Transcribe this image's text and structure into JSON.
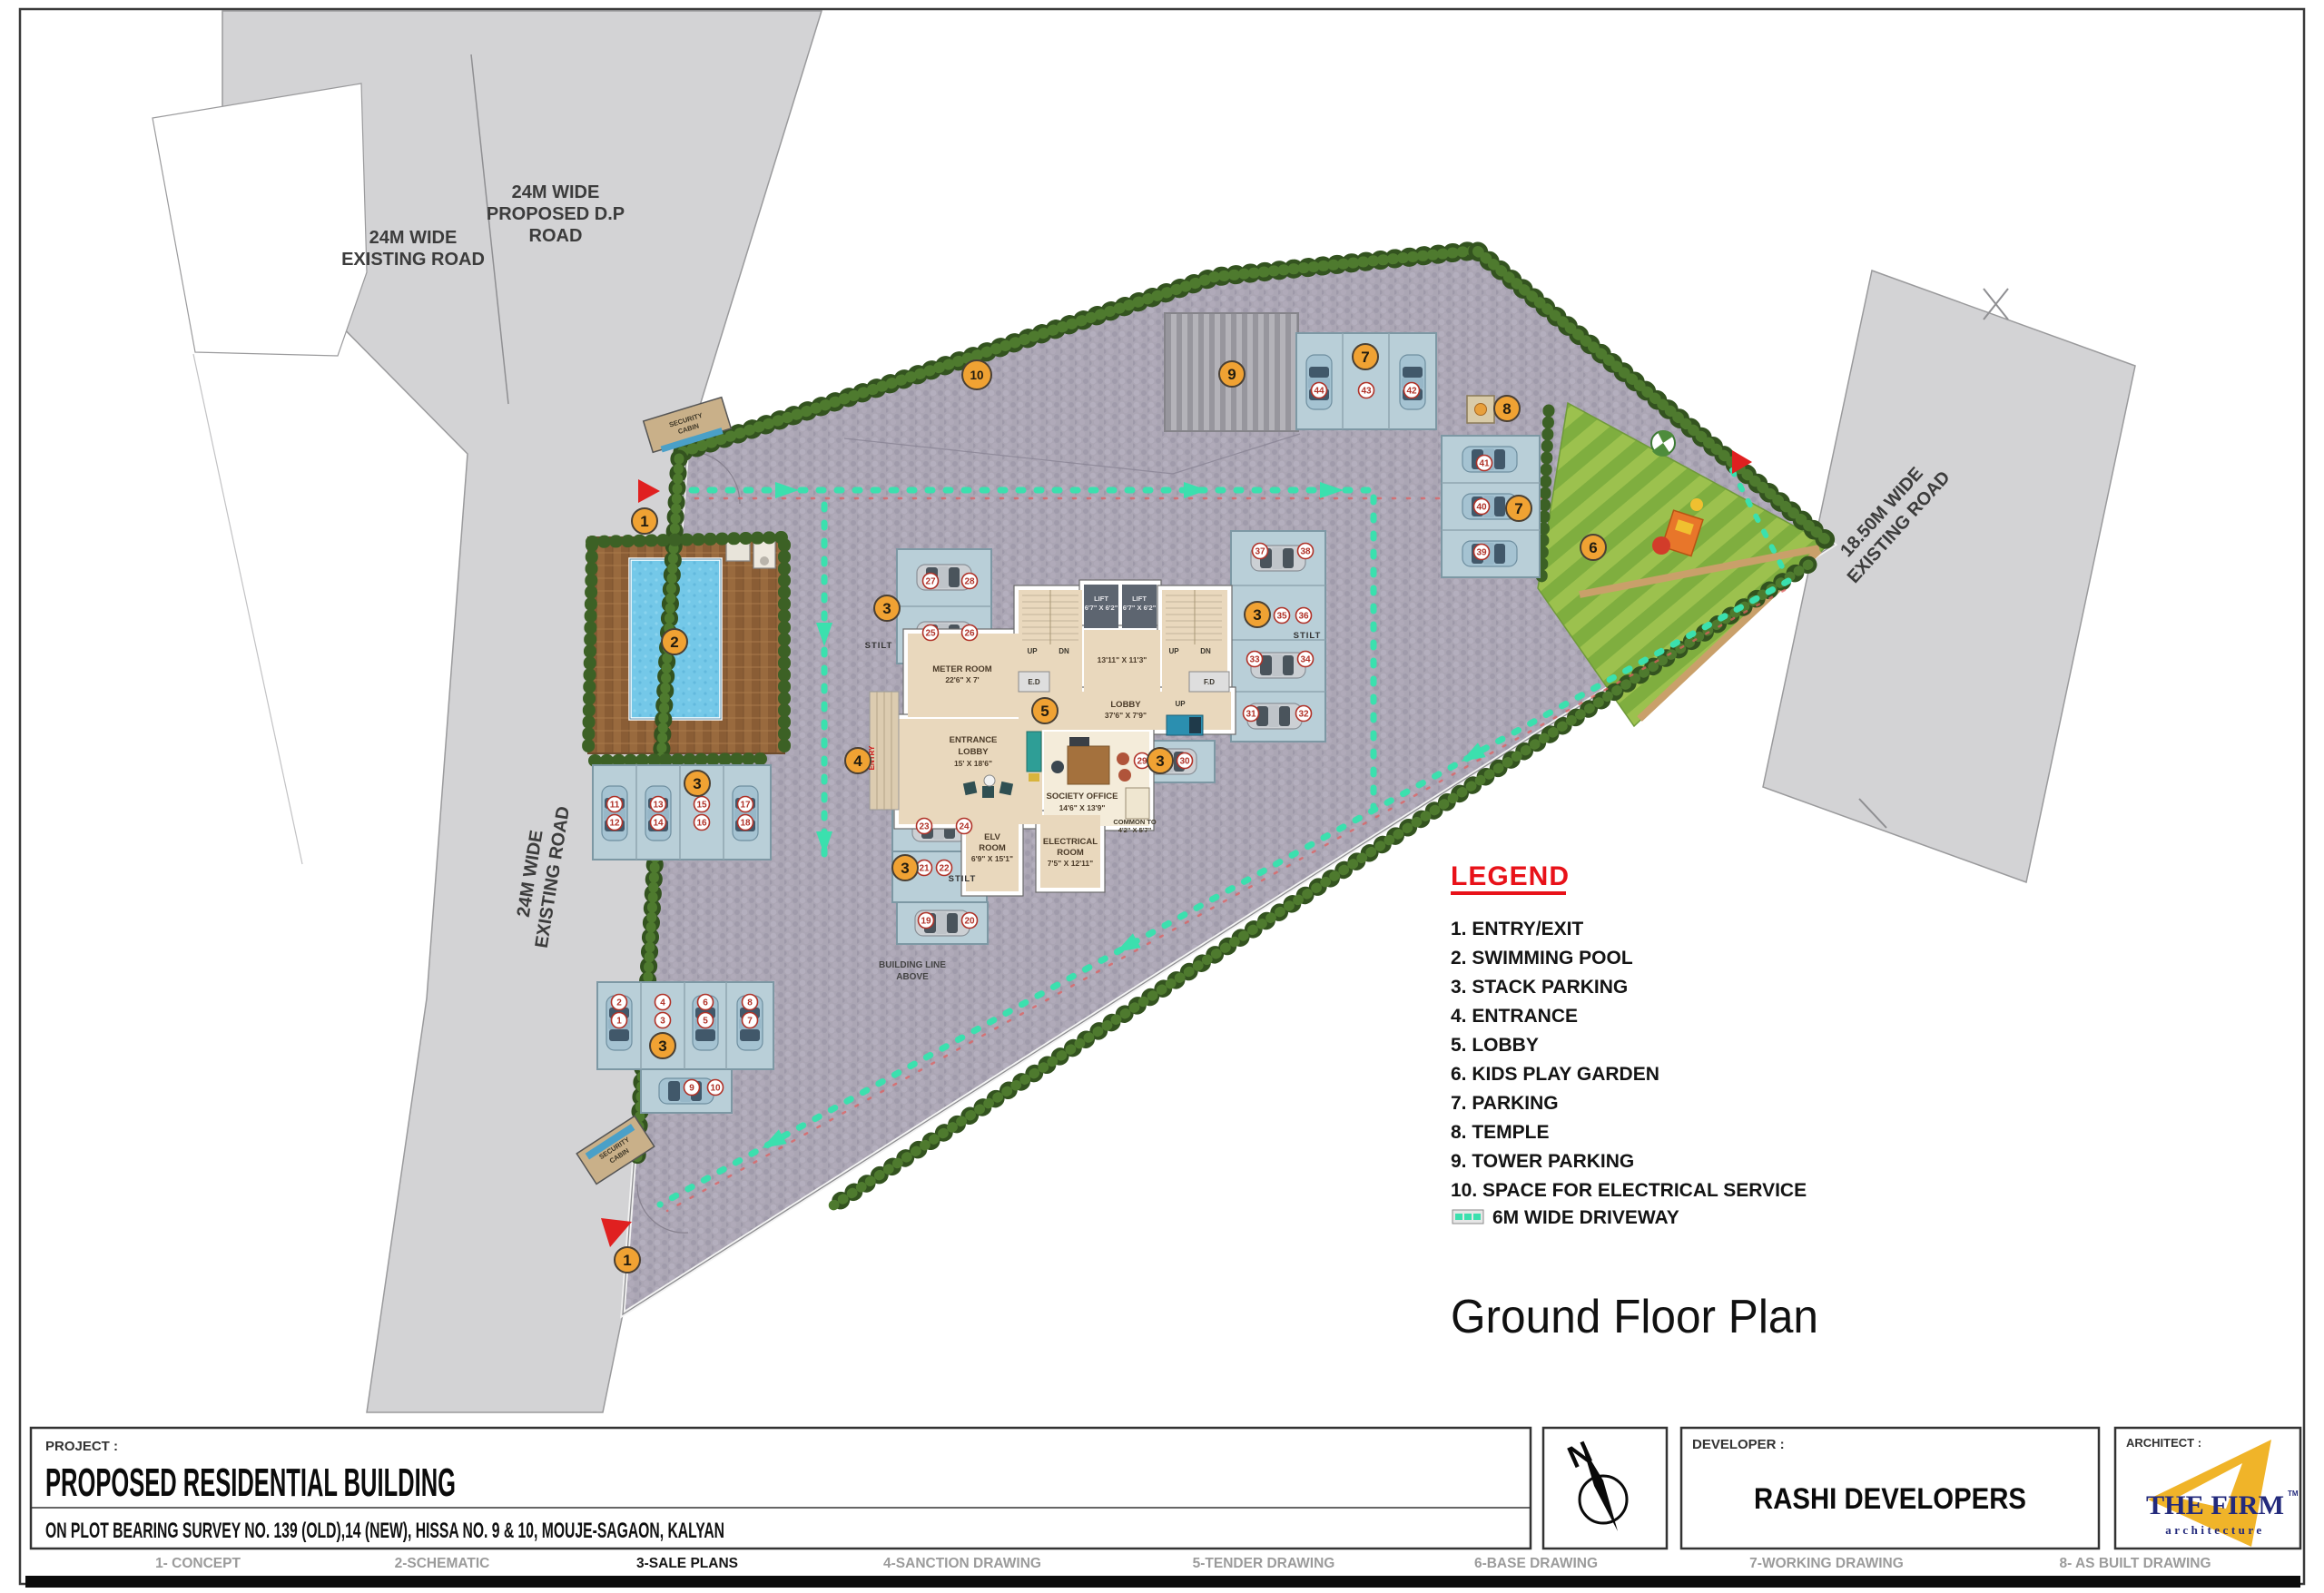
{
  "sheet": {
    "project_label": "PROJECT :",
    "project_title": "PROPOSED RESIDENTIAL BUILDING",
    "project_subtitle": "ON PLOT BEARING SURVEY NO. 139 (OLD),14 (NEW), HISSA NO. 9 & 10, MOUJE-SAGAON, KALYAN",
    "developer_label": "DEVELOPER :",
    "developer_name": "RASHI DEVELOPERS",
    "architect_label": "ARCHITECT :",
    "architect_logo_line1": "THE FIRM",
    "architect_logo_tm": "TM",
    "architect_logo_line2": "architecture",
    "north_letter": "N",
    "plan_title": "Ground Floor Plan"
  },
  "phases": [
    {
      "label": "1- CONCEPT",
      "active": false
    },
    {
      "label": "2-SCHEMATIC",
      "active": false
    },
    {
      "label": "3-SALE PLANS",
      "active": true
    },
    {
      "label": "4-SANCTION DRAWING",
      "active": false
    },
    {
      "label": "5-TENDER DRAWING",
      "active": false
    },
    {
      "label": "6-BASE DRAWING",
      "active": false
    },
    {
      "label": "7-WORKING DRAWING",
      "active": false
    },
    {
      "label": "8- AS BUILT DRAWING",
      "active": false
    }
  ],
  "legend": {
    "title": "LEGEND",
    "items": [
      "1. ENTRY/EXIT",
      "2. SWIMMING POOL",
      "3. STACK PARKING",
      "4. ENTRANCE",
      "5. LOBBY",
      "6. KIDS PLAY GARDEN",
      "7. PARKING",
      "8. TEMPLE",
      "9. TOWER PARKING",
      "10. SPACE FOR ELECTRICAL SERVICE"
    ],
    "driveway_note": "6M WIDE DRIVEWAY"
  },
  "roads": {
    "tl_l1": "24M WIDE",
    "tl_l2": "EXISTING ROAD",
    "dp_l1": "24M WIDE",
    "dp_l2": "PROPOSED D.P",
    "dp_l3": "ROAD",
    "left_l1": "24M WIDE",
    "left_l2": "EXISTING ROAD",
    "right_l1": "18.50M WIDE",
    "right_l2": "EXISTING ROAD"
  },
  "plan": {
    "meter_l1": "METER ROOM",
    "meter_l2": "22'6\" X 7'",
    "lift_l1": "LIFT",
    "lift_l2": "6'7\" X 6'2\"",
    "core_dim": "13'11\" X 11'3\"",
    "lobby_l1": "LOBBY",
    "lobby_l2": "37'6\" X 7'9\"",
    "entrance_l1": "ENTRANCE",
    "entrance_l2": "LOBBY",
    "entrance_l3": "15' X 18'6\"",
    "society_l1": "SOCIETY OFFICE",
    "society_l2": "14'6\" X 13'9\"",
    "common_l1": "COMMON TO",
    "common_l2": "4'2\" X 5'7\"",
    "elv_l1": "ELV",
    "elv_l2": "ROOM",
    "elv_l3": "6'9\" X 15'1\"",
    "elec_l1": "ELECTRICAL",
    "elec_l2": "ROOM",
    "elec_l3": "7'5\" X 12'11\"",
    "ed": "E.D",
    "fd": "F.D",
    "up": "UP",
    "dn": "DN",
    "stilt": "STILT",
    "building_line_l1": "BUILDING LINE",
    "building_line_l2": "ABOVE",
    "security_l1": "SECURITY",
    "security_l2": "CABIN",
    "entry": "ENTRY"
  },
  "plan_markers": [
    "1",
    "1",
    "2",
    "3",
    "3",
    "3",
    "3",
    "3",
    "3",
    "4",
    "5",
    "6",
    "7",
    "7",
    "8",
    "9",
    "10"
  ],
  "car_slot_numbers": [
    "27",
    "28",
    "25",
    "26",
    "37",
    "38",
    "35",
    "36",
    "33",
    "34",
    "31",
    "32",
    "11",
    "12",
    "13",
    "14",
    "15",
    "16",
    "17",
    "18",
    "2",
    "1",
    "4",
    "3",
    "6",
    "5",
    "8",
    "7",
    "9",
    "10",
    "23",
    "24",
    "21",
    "22",
    "19",
    "20",
    "44",
    "43",
    "42",
    "41",
    "40",
    "39",
    "29",
    "30"
  ],
  "colors": {
    "marker_fill": "#f0a233",
    "badge_red": "#b03228",
    "legend_red": "#e81219",
    "driveway_teal": "#3be0ae",
    "paving": "#aba6b4",
    "road_gray": "#d3d3d5",
    "pool_blue": "#74c8e8",
    "deck_wood": "#996a3e",
    "hedge_green": "#33531f",
    "stall_blue": "#b9cfd8",
    "lawn_green": "#9cc14e",
    "logo_yellow": "#f0b429",
    "logo_navy": "#232a7c"
  }
}
